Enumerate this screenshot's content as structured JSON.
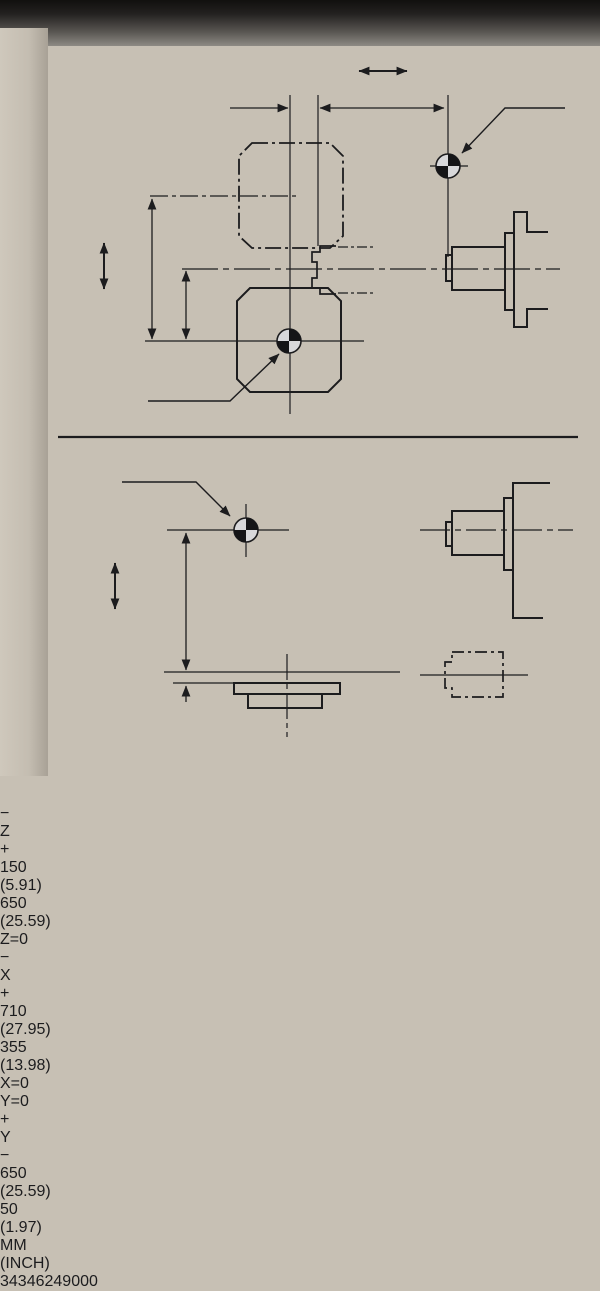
{
  "colors": {
    "ink": "#1c1c1e",
    "plate_light": "#d9d8d6",
    "plate_dark": "#87878a",
    "frame": "#0e0e0e",
    "wall": "#c7c0b4",
    "machine_top": "#11100e",
    "floor": "#c6c3bd"
  },
  "axes": {
    "z": {
      "label": "Z",
      "neg": "−",
      "pos": "+"
    },
    "x": {
      "label": "X",
      "neg": "−",
      "pos": "+"
    },
    "y": {
      "label": "Y",
      "pos": "+",
      "neg": "−"
    }
  },
  "origin_labels": {
    "z": "Z=0",
    "x": "X=0",
    "y": "Y=0"
  },
  "dimensions": {
    "z_center_to_tool": {
      "mm": "150",
      "inch": "(5.91)"
    },
    "z_tool_to_zero": {
      "mm": "650",
      "inch": "(25.59)"
    },
    "x_full": {
      "mm": "710",
      "inch": "(27.95)"
    },
    "x_half": {
      "mm": "355",
      "inch": "(13.98)"
    },
    "y_travel": {
      "mm": "650",
      "inch": "(25.59)"
    },
    "y_table_offset": {
      "mm": "50",
      "inch": "(1.97)"
    }
  },
  "units": {
    "primary": "MM",
    "secondary": "(INCH)"
  },
  "part_number": "34346249000"
}
